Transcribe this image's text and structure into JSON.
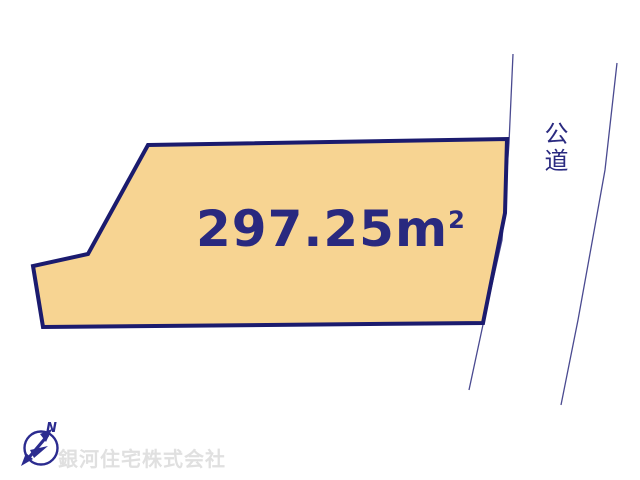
{
  "diagram": {
    "background_color": "#ffffff",
    "parcel": {
      "area_value": "297.25",
      "area_unit_base": "m",
      "area_unit_sup": "2",
      "fill_color": "#f7d492",
      "border_color": "#1b1b6e",
      "text_color": "#29297f"
    },
    "road": {
      "label": "公道",
      "label_color": "#2a2a80",
      "line_color": "#4a4a90"
    },
    "compass": {
      "north_label": "N",
      "color": "#2b2b8f"
    },
    "watermark": {
      "company_name": "銀河住宅株式会社",
      "color": "#e0e0e0"
    }
  }
}
